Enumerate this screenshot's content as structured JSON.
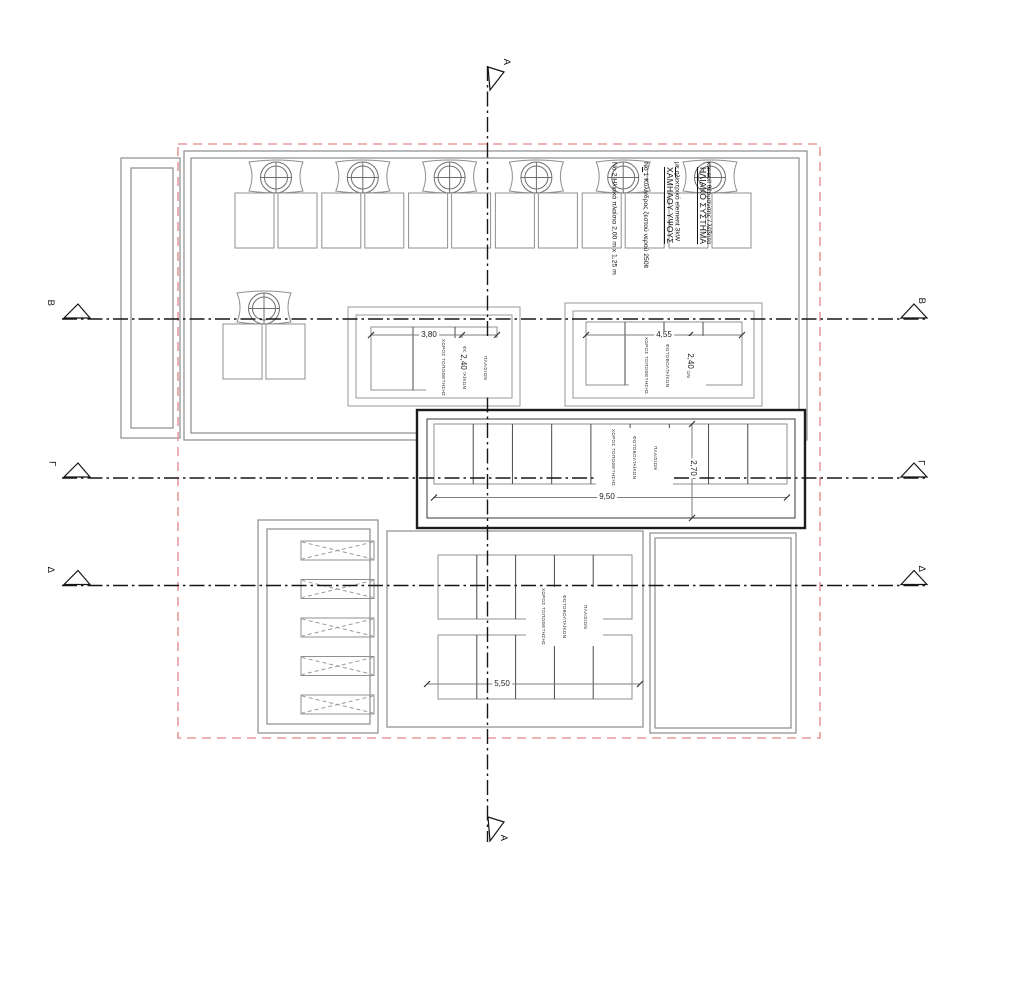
{
  "solar_system_note": {
    "title_lines": [
      "ΗΛΙΑΚΟ ΣΥΣΤΗΜΑ",
      "ΧΑΜΗΛΟΥ ΥΨΟΥΣ"
    ],
    "desc_lines": [
      "Νο 2 Ηλιακά πλαίσια 2,00 m x 1,25 m",
      "Νο 1 Κύλινδρος ζεστού νερού 250lt",
      "με ηλεκτρικό element 3kW",
      "και coil θέρμανσης / λέβητα"
    ]
  },
  "pv_area_label_lines": [
    "ΧΩΡΟΣ ΤΟΠΟΘΕΤΗΣΗΣ",
    "ΦΩΤΟΒΟΛΤΑΪΚΩΝ",
    "ΠΛΑΙΣΙΩΝ"
  ],
  "section_markers": {
    "a": "A",
    "b": "B",
    "gamma": "Γ",
    "delta": "Δ"
  },
  "dimensions": {
    "pv_left_width": "3,80",
    "pv_left_height": "2,40",
    "pv_right_width": "4,55",
    "pv_right_height": "2,40",
    "pv_mid_width": "9,50",
    "pv_mid_height": "2,70",
    "pv_lower_width": "5,50"
  },
  "counts": {
    "solar_units_top_row": 6,
    "solar_units_side": 1,
    "pv_left_columns": 3,
    "pv_right_columns": 4,
    "pv_mid_columns": 9,
    "pv_lower_rows": 2,
    "pv_lower_columns": 5,
    "louver_bars": 5
  },
  "colors": {
    "wall_gray": "#8c8c8c",
    "panel_gray": "#8f8f8f",
    "line_dark": "#1a1a1a",
    "dim_gray": "#7d7d7d",
    "boundary_red": "#e89c9c",
    "text": "#1f1f1f",
    "background": "#ffffff"
  }
}
